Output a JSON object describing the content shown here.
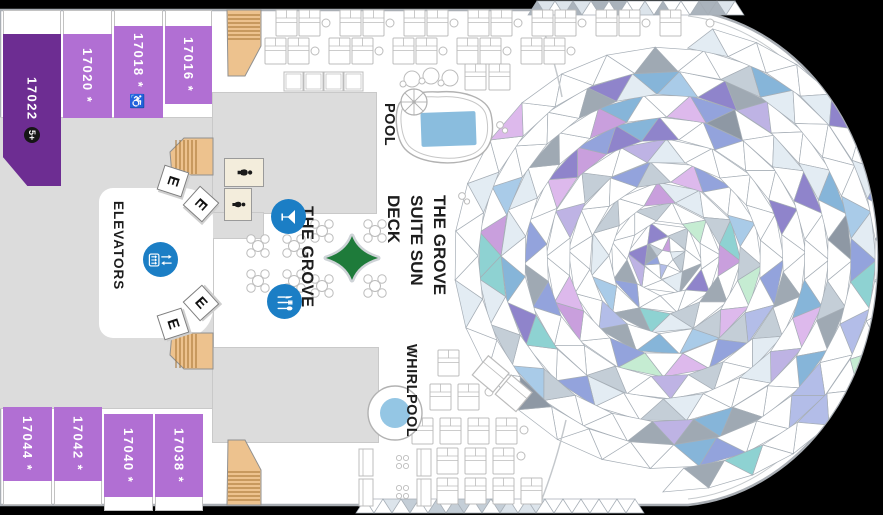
{
  "deck_plan": {
    "labels": {
      "elevators": "ELEVATORS",
      "grove_venue": "THE GROVE",
      "pool": "POOL",
      "whirlpool": "WHIRLPOOL",
      "sun_deck_lines": [
        "THE GROVE",
        "SUITE SUN",
        "DECK"
      ],
      "elevator_letter": "E"
    },
    "cabins": [
      {
        "number": "17022",
        "label": "17022",
        "badge": "5+",
        "tier": "dark"
      },
      {
        "number": "17020",
        "label": "17020 *",
        "tier": "light"
      },
      {
        "number": "17018",
        "label": "17018 * ♿",
        "tier": "light"
      },
      {
        "number": "17016",
        "label": "17016 *",
        "tier": "light"
      },
      {
        "number": "17044",
        "label": "17044 *",
        "tier": "light"
      },
      {
        "number": "17042",
        "label": "17042 *",
        "tier": "light"
      },
      {
        "number": "17040",
        "label": "17040 *",
        "tier": "light"
      },
      {
        "number": "17038",
        "label": "17038 *",
        "tier": "light"
      }
    ],
    "icons": {
      "bar": "martini-glass",
      "dining": "cutlery",
      "elevator": "elevator-panel-arrows",
      "restroom": "person",
      "stairs": "staircase",
      "umbrella": "parasol",
      "compass_star": "four-point-star"
    },
    "colors": {
      "cabin_dark": "#6d2d92",
      "cabin_light": "#b16fd3",
      "corridor": "#dcdcdc",
      "stairs_fill": "#edc28e",
      "stairs_step": "#a3702e",
      "icon_blue": "#1b7ec5",
      "pool_blue": "#8abdde",
      "whirlpool_blue": "#94c6e4",
      "star_green": "#1e7b3a",
      "hull_stroke": "#a9aeb4",
      "line_gray": "#a6aeb6",
      "furn_stroke": "#bcbcbc",
      "cream": "#f3eddc",
      "text_black": "#1d1d1d"
    },
    "mosaic": {
      "seed": 9,
      "palette": [
        [
          "#ffffff",
          60
        ],
        [
          "#e3ecf3",
          6
        ],
        [
          "#c4ced7",
          5
        ],
        [
          "#9fa9b3",
          4
        ],
        [
          "#86b5d9",
          4
        ],
        [
          "#a9cbe8",
          3
        ],
        [
          "#93a3dc",
          3
        ],
        [
          "#b3bde8",
          2
        ],
        [
          "#8f84cb",
          3
        ],
        [
          "#beb3e4",
          2
        ],
        [
          "#c99fdd",
          2
        ],
        [
          "#ddb9ec",
          2
        ],
        [
          "#c5ecd2",
          2
        ],
        [
          "#8ed2d2",
          2
        ],
        [
          "#8e98a4",
          1
        ]
      ]
    }
  }
}
